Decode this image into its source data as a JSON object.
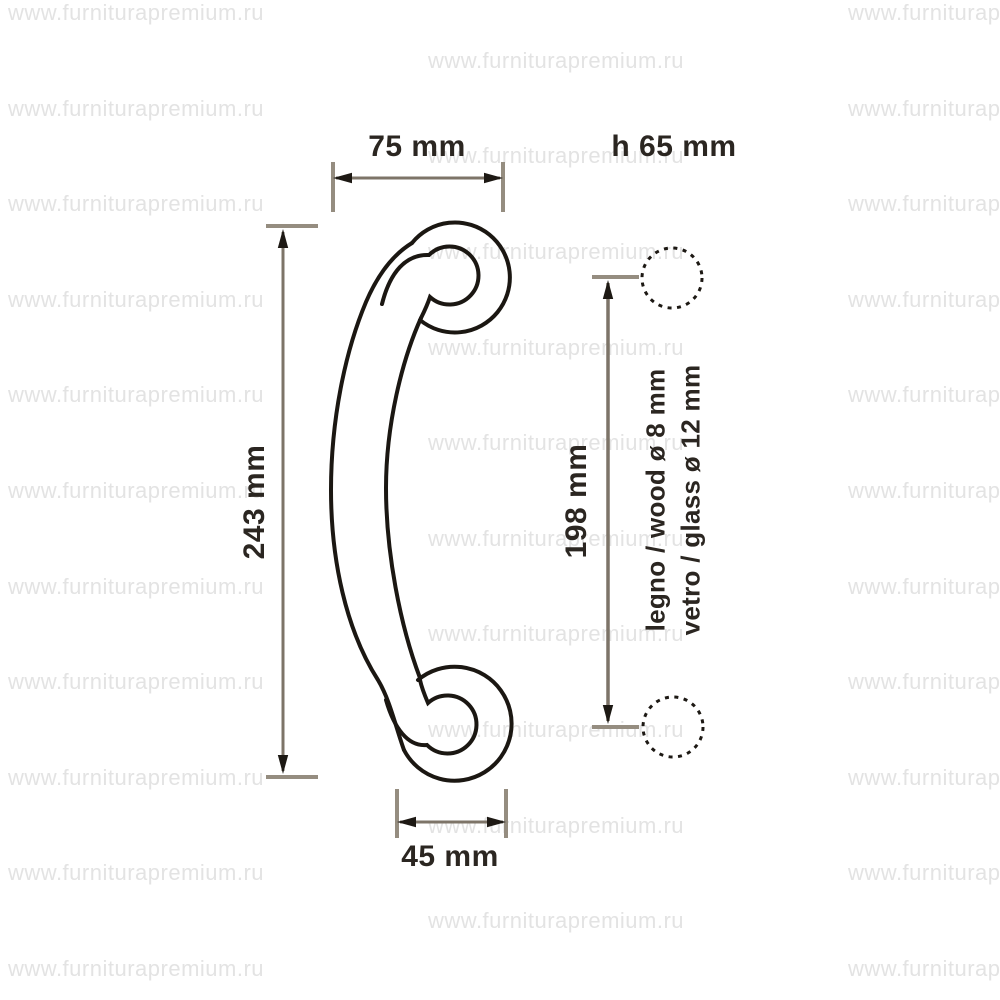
{
  "page_type": "product technical dimension drawing",
  "product": "curved door pull handle (side profile with two round mounting posts)",
  "watermark": {
    "text": "www.furniturapremium.ru",
    "grid": {
      "start_y": 2,
      "row_step": 47.8,
      "rows": 21,
      "cols_even": [
        8,
        848
      ],
      "cols_odd": [
        428
      ]
    }
  },
  "labels": {
    "dim_75": "75 mm",
    "h_65": "h 65 mm",
    "dim_243": "243 mm",
    "dim_198": "198 mm",
    "dim_45": "45 mm",
    "legno": "legno / wood ø 8 mm",
    "vetro": "vetro / glass ø 12 mm"
  },
  "colors": {
    "watermark": "#e3e3e3",
    "outline": "#1b1712",
    "dim_line": "#7d7468",
    "tick": "#958d80",
    "arrow": "#1d1914",
    "text": "#2b2621",
    "bg": "#ffffff"
  }
}
